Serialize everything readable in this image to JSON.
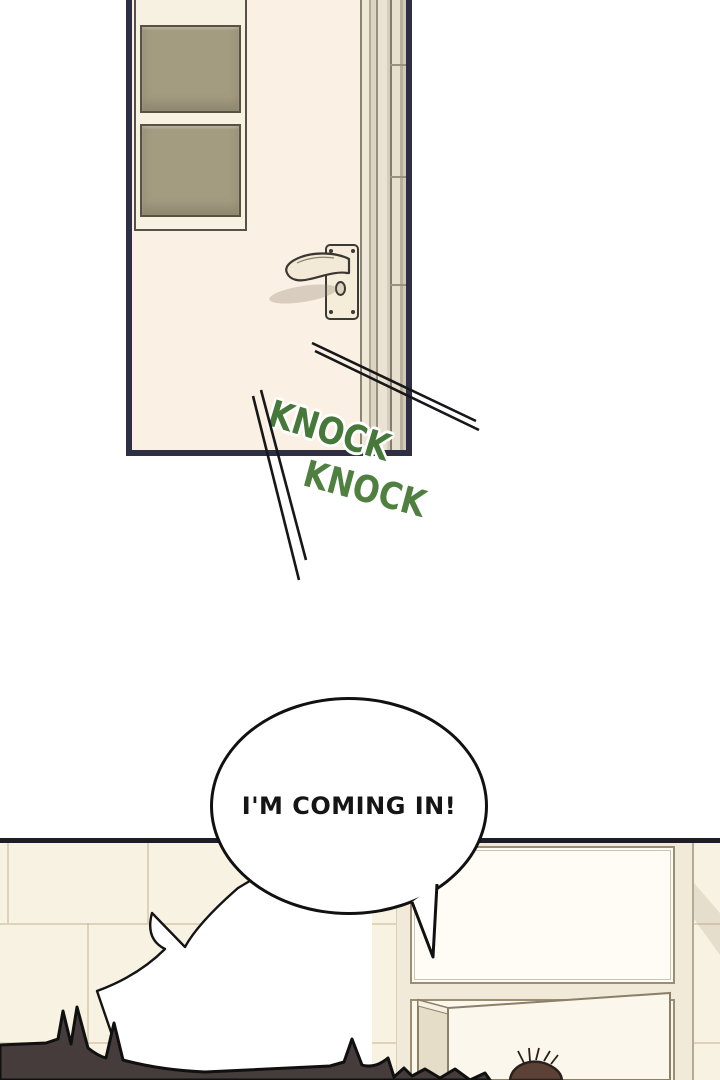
{
  "speech": {
    "text": "I'M COMING IN!"
  },
  "sfx": {
    "knock1": "KNOCK",
    "knock2": "KNOCK"
  },
  "scene": {
    "top": "closed cream door with two olive glass panes and lever handle",
    "bottom": "tiled bathroom wall, doorway with open inner door, two characters' hair visible"
  },
  "colors": {
    "sfx_green": "#4a7c3a",
    "door_outline_navy": "#2e2e44",
    "door_pane_olive": "#a49c81",
    "door_face_cream": "#faf0e3",
    "wall_cream": "#f8f2e2",
    "panel_line": "#1d1d29",
    "hair_dark": "#463c3c",
    "hair_brown": "#5c4137"
  }
}
